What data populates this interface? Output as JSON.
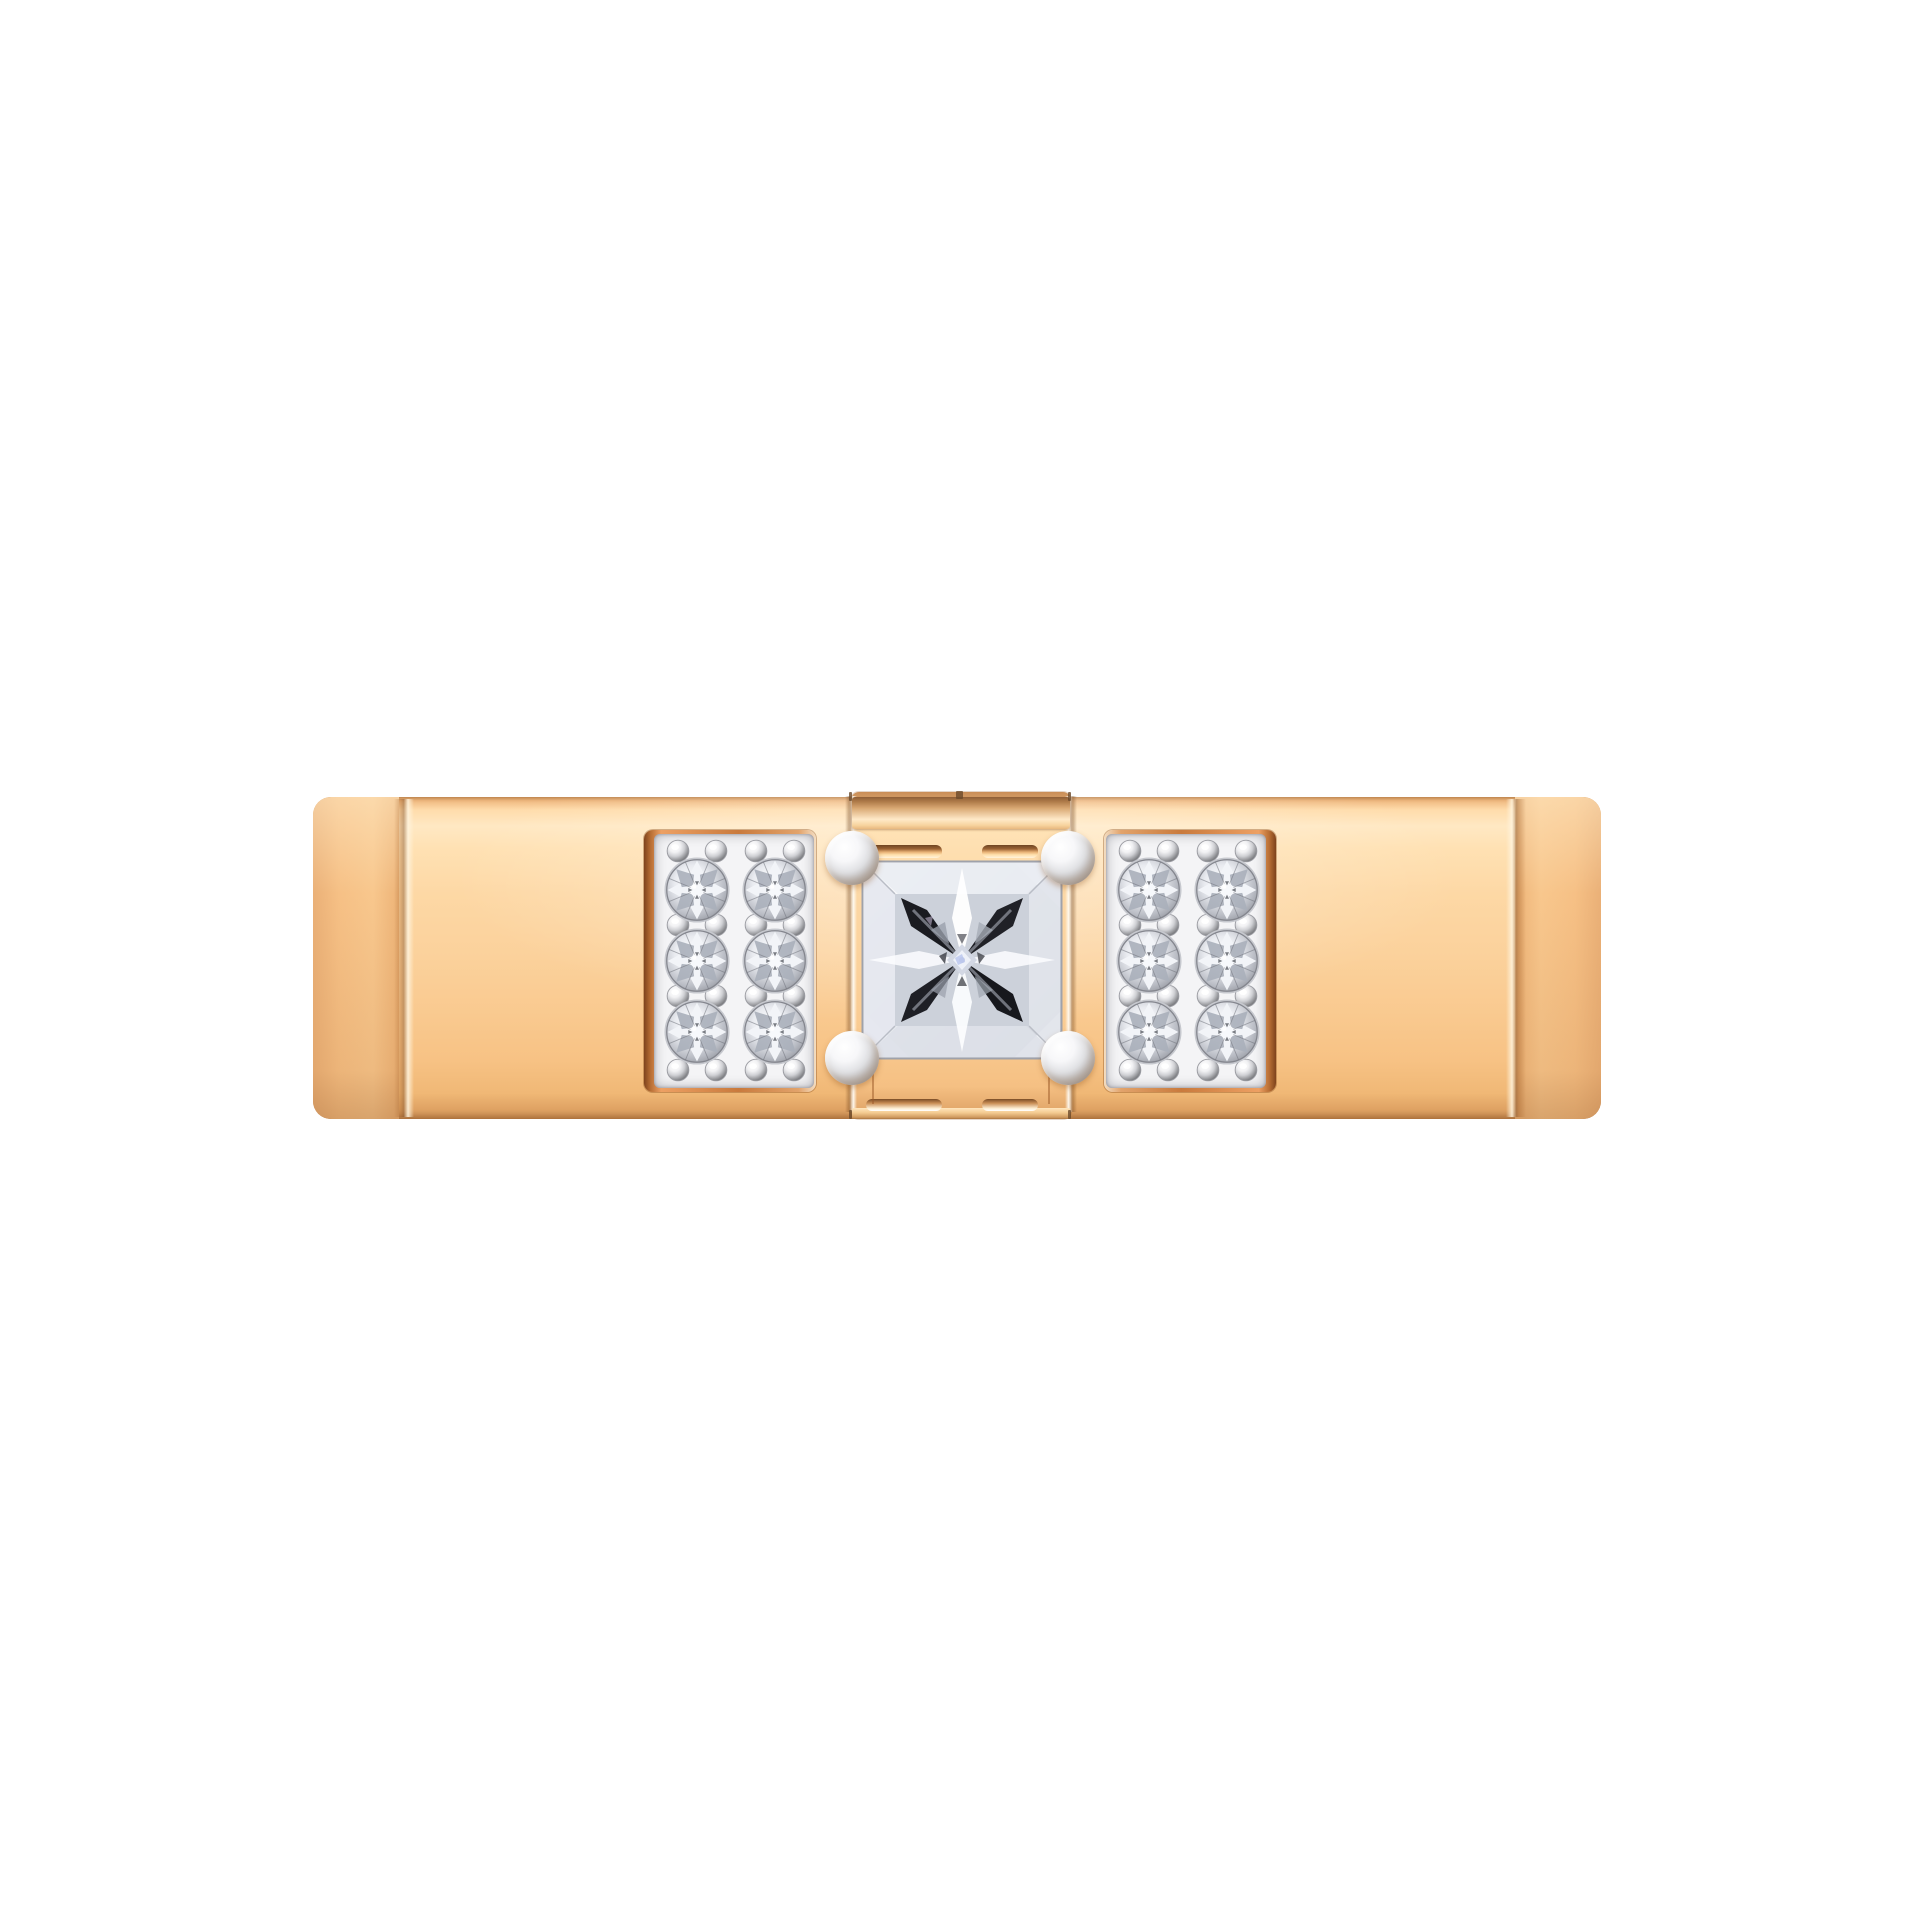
{
  "image": {
    "alt": "Close-up product photo on a plain white background: front view of a wide polished rose gold ring band set with a central princess-cut diamond held by four white-gold bead prongs, flanked by two white-gold pave panels each bead-set with six round brilliant diamonds in two columns of three rows",
    "category": "jewelry-product-photo",
    "background": "plain white"
  },
  "ring": {
    "style": "wide flat band, front view",
    "band_metal": "polished rose gold",
    "center_setting": {
      "stone_cut": "princess",
      "stone_count": 1,
      "prong_count": 4,
      "prong_metal": "white gold"
    },
    "pave_panels": {
      "panel_count": 2,
      "panel_metal": "white gold with copper-gold rim",
      "stones_per_panel": 6,
      "stone_rows": 3,
      "stone_columns": 2,
      "stone_cut": "round brilliant",
      "bead_prongs_per_panel": 16,
      "total_pave_stones": 12
    },
    "total_diamonds": 13
  },
  "theme": {
    "bg": "#ffffff",
    "gold-hi": "#ffe8c3",
    "gold-mid": "#fbd19b",
    "gold-deep": "#f7c284",
    "gold-edge": "#c28852",
    "copper": "#c97a3d",
    "white-metal": "#f4f4f6",
    "metal-shade": "#94959b",
    "diamond-lite": "#ffffff",
    "diamond-gray": "#b9bcc4",
    "diamond-dark": "#1a1b20"
  }
}
